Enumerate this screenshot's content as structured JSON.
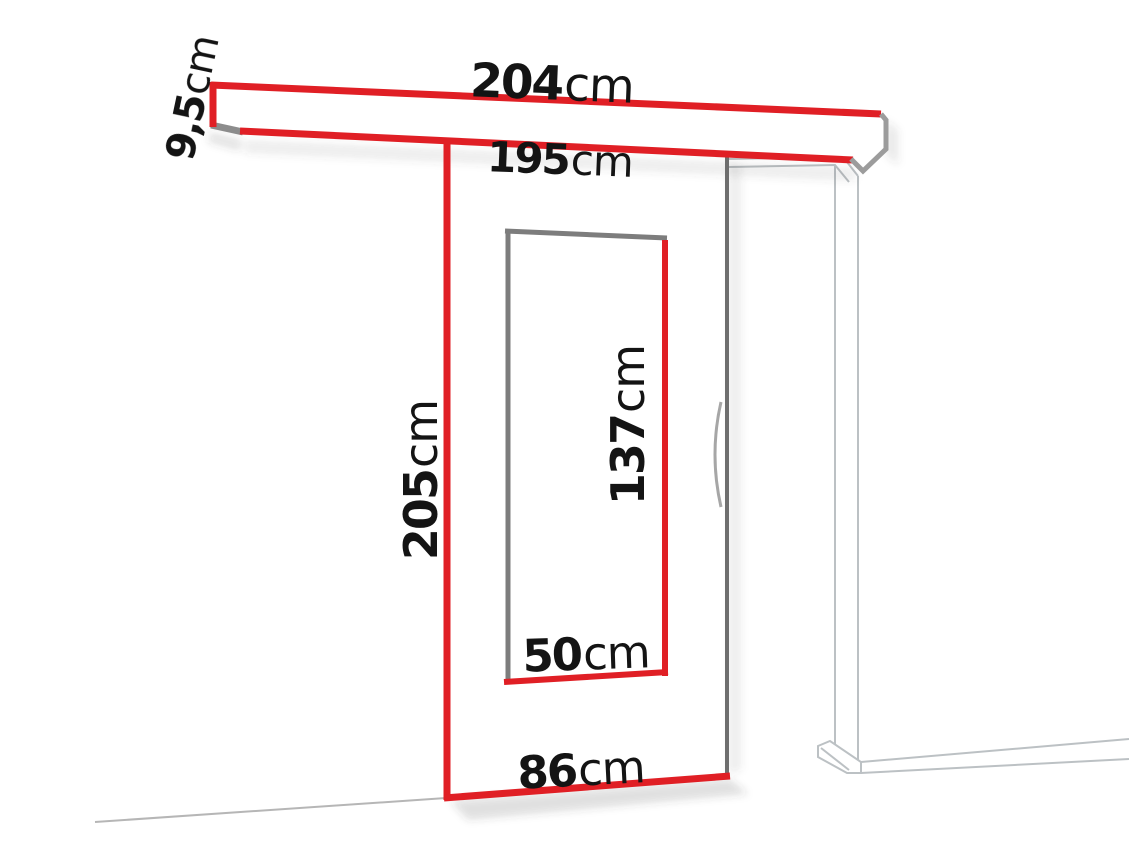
{
  "figure": {
    "name": "sliding-door-system-dimension-diagram",
    "description_labels_only": true
  },
  "labels": {
    "rail_length": {
      "value": "204",
      "unit": "cm"
    },
    "rail_height": {
      "value": "9,5",
      "unit": "cm"
    },
    "rail_inner_length": {
      "value": "195",
      "unit": "cm"
    },
    "door_height": {
      "value": "205",
      "unit": "cm"
    },
    "window_height": {
      "value": "137",
      "unit": "cm"
    },
    "window_width": {
      "value": "50",
      "unit": "cm"
    },
    "door_width": {
      "value": "86",
      "unit": "cm"
    }
  },
  "colors": {
    "red": "#e01f25",
    "text": "#141414",
    "door-edge": "#6e6e6e",
    "window-gray": "#7d7d7d",
    "rail-gray": "#8c8c8c",
    "rail-cap-gray": "#9c9c9c",
    "frame-gray": "#bcc1c4",
    "handle-gray": "#a6a6a6",
    "floor-gray": "#b6b6b6",
    "background": "#ffffff"
  }
}
